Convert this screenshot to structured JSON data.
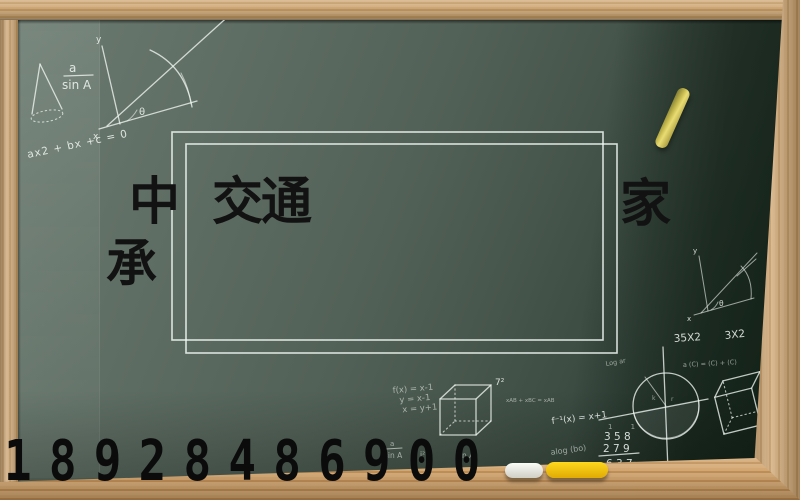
{
  "scene": {
    "title_fragments": {
      "f1": "中",
      "f2": "交通",
      "f3": "家",
      "f4": "承"
    },
    "phone_number": "18928486900",
    "chalk": {
      "frac_a": "a",
      "frac_sin": "sin A",
      "quadratic": "ax2 + bx +c = 0",
      "axis_y": "y",
      "axis_x": "x",
      "theta": "θ",
      "mul_35x2": "35X2",
      "mul_3x2": "3X2",
      "log_small": "Log ar",
      "matrix_eq": "a (C) = (C) + (C)",
      "fx_line1": "f(x) = x-1",
      "fx_line2": "y = x-1",
      "fx_line3": "x = y+1",
      "seven_squared": "7²",
      "vector_eq": "xAB + xBC = xAB",
      "f_inverse": "f⁻¹(x) = x+1",
      "carry_digits": "1 1",
      "add_row1": "3 5 8",
      "add_row2": "2 7 9",
      "add_row3": "6 3 7",
      "alog": "alog (bo)",
      "small_sq": "i²",
      "sin_small": "sin A",
      "circle_k": "k",
      "circle_r": "r"
    },
    "colors": {
      "board_green_dark": "#203226",
      "board_green_light": "#6d7c72",
      "wood_frame": "#c8a06a",
      "wood_tray": "#c29058",
      "chalk_white": "#f2f5f1",
      "chalk_yellow": "#f2c30d",
      "stick_yellow": "#d9cb58",
      "title_black": "#121212"
    }
  }
}
